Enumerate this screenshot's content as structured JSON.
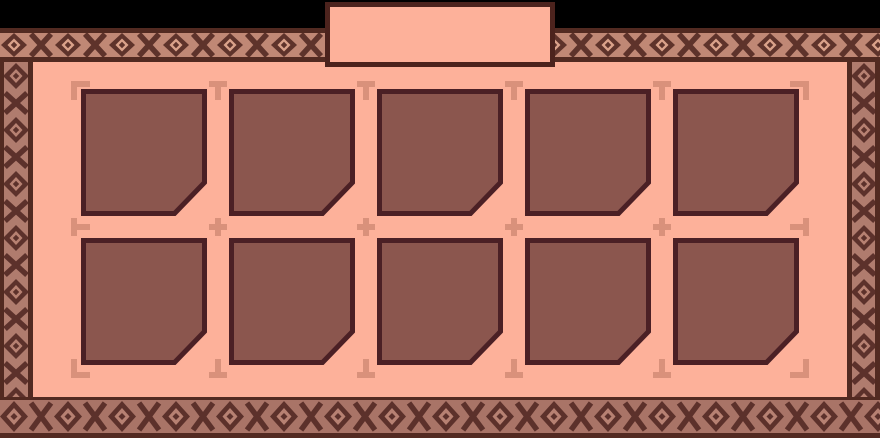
{
  "window": {
    "width": 880,
    "height": 438,
    "background": "#000000"
  },
  "title_tab": {
    "label": ""
  },
  "slot_grid": {
    "rows": 2,
    "columns": 5,
    "slot_count": 10,
    "slot_width": 126,
    "slot_height": 127,
    "col_lefts": [
      81,
      229,
      377,
      525,
      673
    ],
    "row_tops": [
      89,
      238
    ],
    "slots": [
      {
        "row": 1,
        "col": 1,
        "content": ""
      },
      {
        "row": 1,
        "col": 2,
        "content": ""
      },
      {
        "row": 1,
        "col": 3,
        "content": ""
      },
      {
        "row": 1,
        "col": 4,
        "content": ""
      },
      {
        "row": 1,
        "col": 5,
        "content": ""
      },
      {
        "row": 2,
        "col": 1,
        "content": ""
      },
      {
        "row": 2,
        "col": 2,
        "content": ""
      },
      {
        "row": 2,
        "col": 3,
        "content": ""
      },
      {
        "row": 2,
        "col": 4,
        "content": ""
      },
      {
        "row": 2,
        "col": 5,
        "content": ""
      }
    ]
  },
  "markers": {
    "layout": [
      [
        "tl",
        "t",
        "t",
        "t",
        "t",
        "tr"
      ],
      [
        "l",
        "c",
        "c",
        "c",
        "c",
        "r"
      ],
      [
        "bl",
        "b",
        "b",
        "b",
        "b",
        "br"
      ]
    ],
    "col_lefts": [
      71,
      208,
      356,
      504,
      652,
      789
    ],
    "row_tops": [
      81,
      217,
      358
    ]
  },
  "colors": {
    "background": "#000000",
    "panel": "#fdb19a",
    "frame_dark": "#522a21",
    "tab_border": "#4c231d",
    "slot_fill": "#8b564e",
    "slot_border": "#4b2025",
    "marker": "#d9917b",
    "band_top_bg": "#c08875",
    "band_top_motif": "#5e332b",
    "band_top_inner": "#daa28a",
    "band_side_bg": "#b07c6e",
    "band_side_motif": "#5c312b",
    "band_side_inner": "#b78172",
    "band_bottom_bg": "#a97467"
  }
}
